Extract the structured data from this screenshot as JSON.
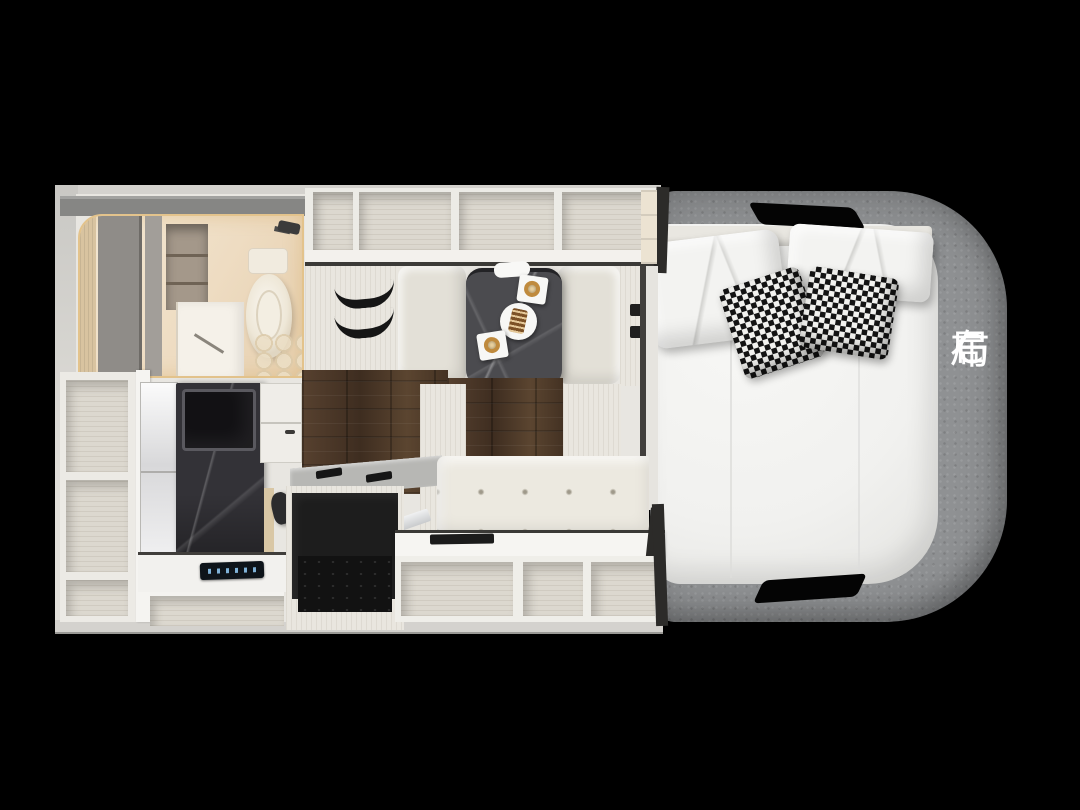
{
  "canvas": {
    "width": 1080,
    "height": 810,
    "background": "#000000"
  },
  "label": {
    "text": "C布局",
    "chars": [
      "C",
      "布",
      "局"
    ],
    "color": "#ffffff",
    "orientation": "vertical-right-side"
  },
  "palette": {
    "bg": "#000000",
    "wall": "#d4d2ce",
    "wallLight": "#e8e6e1",
    "trimDark": "#2c2b29",
    "cream": "#f3e8d5",
    "creamDeep": "#e6cfae",
    "grayPartition": "#8f8c88",
    "lockerFace": "#ecebe6",
    "lockerIn": "#dcd8cf",
    "wood": "#4a3526",
    "stone": "#4b4b4f",
    "stoneDark": "#333237",
    "bench": "#e3e0d7",
    "sofa": "#ece9e0",
    "counter": "#f2f1ee",
    "appliance": "#1d1d1d",
    "panelBlue": "#7fb2d8",
    "fabric": "#8f9193",
    "mattress": "#f1f1ef",
    "pillow": "#f3f3f1",
    "houndDark": "#141414",
    "houndLight": "#f2f2ef",
    "label": "#ffffff"
  },
  "floorplan": {
    "view": "top-down-cutaway",
    "vehicle": "motorhome",
    "zones": [
      {
        "name": "bathroom",
        "items": [
          "toilet",
          "shower-door",
          "storage-niche",
          "shower-head",
          "gray-partition",
          "hex-tile-floor"
        ]
      },
      {
        "name": "overhead-lockers",
        "compartments": 4
      },
      {
        "name": "strap-wardrobe",
        "items": [
          "elastic-strap",
          "elastic-strap"
        ]
      },
      {
        "name": "dinette",
        "items": [
          "stone-table",
          "bench-seat-left",
          "bench-seat-right",
          "coffee-cup-plate",
          "coffee-cup-plate",
          "dessert-plate",
          "napkin"
        ]
      },
      {
        "name": "kitchen",
        "items": [
          "tv-stone-column",
          "tv-screen",
          "mirror-cabinet",
          "overhead-cabinet",
          "counter",
          "cooktop-control-panel",
          "refrigerator",
          "faucet",
          "wood-floor"
        ]
      },
      {
        "name": "lounge",
        "items": [
          "tufted-sofa",
          "side-counter",
          "storage-cubby",
          "storage-cubby",
          "storage-cubby"
        ]
      },
      {
        "name": "left-shelf-unit",
        "compartments": 3
      },
      {
        "name": "bedroom",
        "items": [
          "double-mattress",
          "headboard",
          "white-pillow",
          "white-pillow",
          "houndstooth-pillow",
          "houndstooth-pillow",
          "fabric-surround",
          "handle-cutout-top",
          "handle-cutout-bottom"
        ]
      }
    ]
  }
}
